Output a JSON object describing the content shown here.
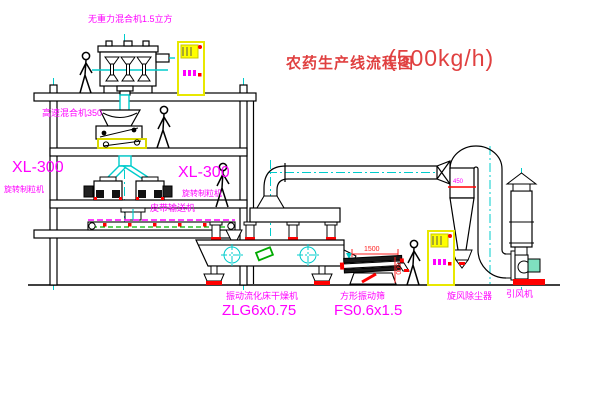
{
  "title": {
    "text": "农药生产线流程图",
    "capacity": "(500kg/h)"
  },
  "equipment": {
    "gravity_mixer": {
      "label": "无重力混合机1.5立方"
    },
    "high_speed_mixer": {
      "label": "高速混合机350"
    },
    "granulator_left": {
      "model": "XL-300",
      "name": "旋转制粒机"
    },
    "granulator_right": {
      "model": "XL-300",
      "name": "旋转制粒机"
    },
    "belt_conveyor": {
      "name": "皮带输送机"
    },
    "fluid_bed_dryer": {
      "name": "振动流化床干燥机",
      "model": "ZLG6x0.75"
    },
    "square_screen": {
      "name": "方形振动筛",
      "model": "FS0.6x1.5"
    },
    "cyclone": {
      "name": "旋风除尘器"
    },
    "induced_fan": {
      "name": "引风机"
    }
  },
  "dimensions": {
    "screen_length": "1500",
    "screen_width": "600",
    "cyclone_inlet": "450"
  },
  "colors": {
    "label_magenta": "#ff00ff",
    "title_red": "#e04040",
    "line_black": "#000000",
    "pipe_cyan": "#00cccc",
    "panel_yellow": "#ffff00",
    "accent_red": "#ff0000",
    "accent_green": "#00bb00"
  }
}
